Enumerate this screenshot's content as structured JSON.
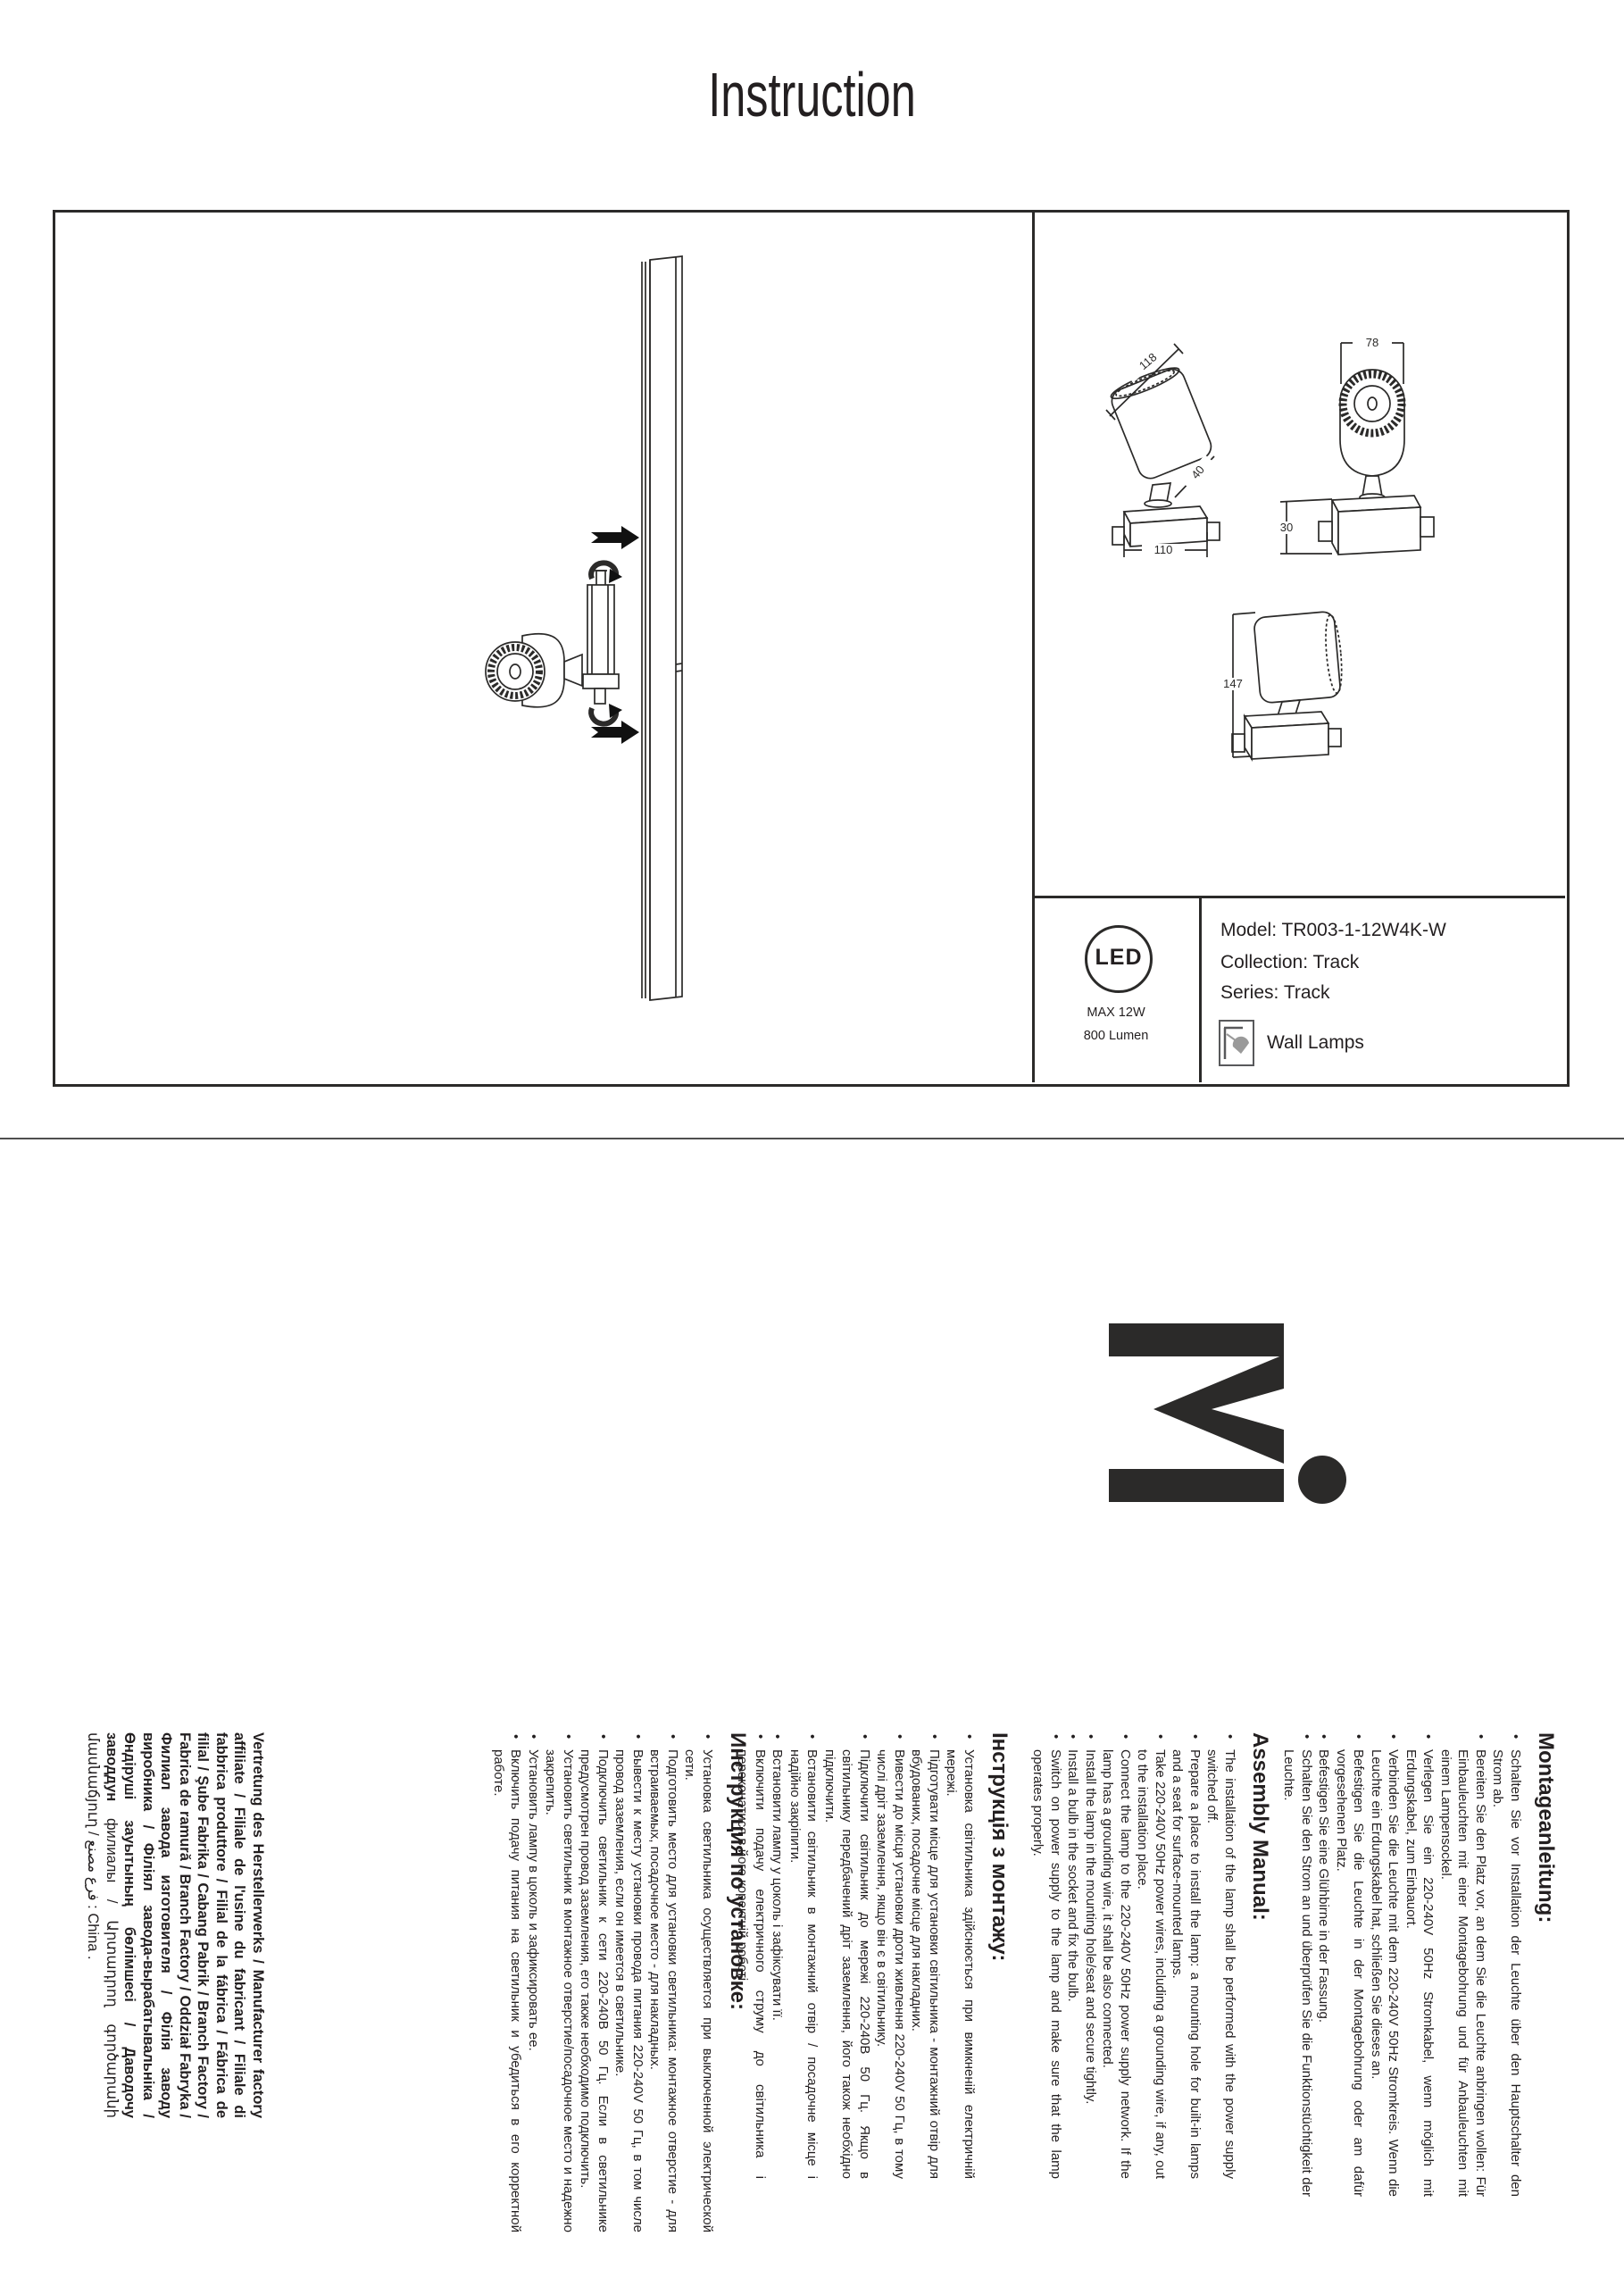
{
  "page": {
    "title": "Instruction"
  },
  "product": {
    "model_line": "Model: TR003-1-12W4K-W",
    "collection_line": "Collection: Track",
    "series_line": "Series: Track",
    "category": "Wall Lamps",
    "led_badge": {
      "label": "LED",
      "max_power": "MAX 12W",
      "luminous_flux": "800 Lumen"
    }
  },
  "dimensions_mm": {
    "head_length": "118",
    "adapter": "40",
    "base_width": "110",
    "head_diameter": "78",
    "base_height": "30",
    "total_height": "147"
  },
  "colors": {
    "ink": "#231f20",
    "line_art": "#2b2a29",
    "icon_gray": "#9a9a9a",
    "separator": "#4f4f4f"
  },
  "sections": [
    {
      "lang": "de",
      "heading": "Montageanleitung:",
      "items": [
        "Schalten Sie vor Installation der Leuchte über den Hauptschalter den Strom ab.",
        "Bereiten Sie den Platz vor, an dem Sie die Leuchte anbringen wollen: Für Einbauleuchten mit einer Montagebohrung und für Anbauleuchten mit einem Lampensockel.",
        "Verlegen Sie ein 220-240V 50Hz Stromkabel, wenn möglich mit Erdungskabel, zum Einbauort.",
        "Verbinden Sie die Leuchte mit dem 220-240V 50Hz Stromkreis. Wenn die Leuchte ein Erdungskabel hat, schließen Sie dieses an.",
        "Befestigen Sie die Leuchte in der Montagebohrung oder am dafür vorgesehenen Platz.",
        "Befestigen Sie eine Glühbirne in der Fassung.",
        "Schalten Sie den Strom an und überprüfen Sie die Funktionstüchtigkeit der Leuchte."
      ]
    },
    {
      "lang": "en",
      "heading": "Assembly Manual:",
      "items": [
        "The installation of the lamp shall be performed with the power supply switched off.",
        "Prepare a place to install the lamp: a mounting hole for built-in lamps and a seat for surface-mounted lamps.",
        "Take 220-240V 50Hz power wires, including a grounding wire, if any, out to the installation place.",
        "Connect the lamp to the 220-240V 50Hz power supply network. If the lamp has a grounding wire, it shall be also connected.",
        "Install the lamp in the mounting hole/seat and secure tightly.",
        "Install a bulb in the socket and fix the bulb.",
        "Switch on power supply to the lamp and make sure that the lamp operates properly."
      ]
    },
    {
      "lang": "uk",
      "heading": "Інструкція з монтажу:",
      "items": [
        "Установка світильника здійснюється при вимкненій електричній мережі.",
        "Підготувати місце для установки світильника - монтажний отвір для вбудованих, посадочне місце для накладних.",
        "Вивести до місця установки дроти живлення 220-240V 50 Гц, в тому числі дріт заземлення, якщо він є в світильнику.",
        "Підключити світильник до мережі 220-240В 50 Гц. Якщо в світильнику передбачений дріт заземлення, його також необхідно підключити.",
        "Встановити світильник в монтажний отвір / посадочне місце і надійно закріпити.",
        "Встановити лампу у цоколь і зафіксувати її.",
        "Включити подачу електричного струму до світильника і переконатися в його коректній роботі."
      ]
    },
    {
      "lang": "ru",
      "heading": "Инструкция по установке:",
      "items": [
        "Установка светильника осуществляется при выключенной электрической сети.",
        "Подготовить место для установки светильника: монтажное отверстие - для встраиваемых, посадочное место - для накладных.",
        "Вывести к месту установки провода питания 220-240V 50 Гц, в том числе провод заземления, если он имеется в светильнике.",
        "Подключить светильник к сети 220-240В 50 Гц. Если в светильнике предусмотрен провод заземления, его также необходимо подключить.",
        "Установить светильник в монтажное отверстие/посадочное место и надежно закрепить.",
        "Установить лампу в цоколь и зафиксировать ее.",
        "Включить подачу питания на светильник и убедиться в его корректной работе."
      ]
    }
  ],
  "manufacturer": {
    "bold": "Vertretung des Herstellerwerks / Manufacturer factory affiliate / Filiale de l'usine du fabricant / Filiale di fabbrica produttore / Filial de la fábrica / Fábrica de filial / Şube Fabrika / Cabang Pabrik / Branch Factory / Fabrica de ramură / Branch Factory / Oddział Fabryka / Филиал завода изготовителя / Філія заводу виробника / Філіял завода-вырабатывальніка / Өндіруші зауытының бөлімшесі / Даводочу заводдун ",
    "regular": "филиалы / Արտադրող գործարանի մասնաճյուղ / فرع مصنع : China ."
  }
}
